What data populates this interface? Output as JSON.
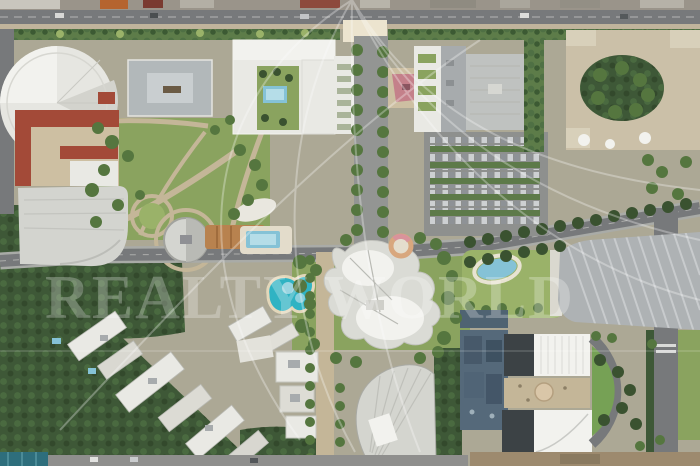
{
  "watermark": {
    "text": "REALTY WORLD"
  },
  "colors": {
    "ground": "#aca895",
    "park": "#8aa35f",
    "lawn": "#9ab269",
    "forest": "#3e5837",
    "tree": "#55763f",
    "tree_dark": "#3a5230",
    "road": "#77797b",
    "road_light": "#939593",
    "path_tan": "#c4b698",
    "sidewalk": "#c0b49c",
    "plaza": "#ece4cf",
    "building_white": "#e9e9e4",
    "building_light": "#f2f2ee",
    "building_gray": "#bfc2c0",
    "roof_gray": "#a7abad",
    "roof_dark": "#3c4245",
    "red_roof": "#a34a38",
    "pink_roof": "#c4808a",
    "courtyard_tan": "#cdbfa2",
    "pool": "#85c2d6",
    "pool_light": "#b5dde8",
    "lagoon": "#2fb3c3",
    "teal_roof": "#2e6e7c",
    "orange": "#b8824f",
    "tan_building": "#cbc0a8",
    "glass": "#55697a",
    "watermark": "#ffffff"
  }
}
